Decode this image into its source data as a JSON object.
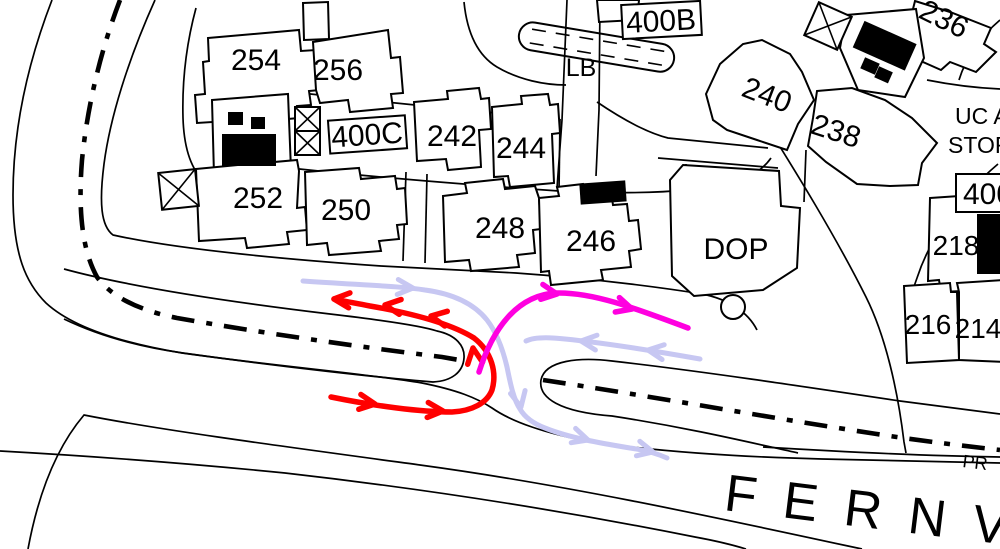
{
  "map": {
    "buildings": {
      "b254": "254",
      "b256": "256",
      "b252": "252",
      "b250": "250",
      "b248": "248",
      "b246": "246",
      "b242": "242",
      "b244": "244",
      "b240": "240",
      "b238": "238",
      "b236": "236",
      "b218": "218",
      "b216": "216",
      "b214": "214",
      "b400b": "400B",
      "b400c": "400C",
      "b400": "400"
    },
    "areas": {
      "dop": "DOP",
      "lb": "LB",
      "uc_line1": "UC AT",
      "uc_line2": "STOR",
      "pr": "PR"
    },
    "street": {
      "name": "FERNV"
    },
    "routes": {
      "red": {
        "color": "#ff0000"
      },
      "magenta": {
        "color": "#ff00e0"
      },
      "lavender": {
        "color": "#c7c7f2"
      }
    },
    "highlights": {
      "building_248": "#ffff00",
      "building_246": "#f5f0c2"
    }
  }
}
